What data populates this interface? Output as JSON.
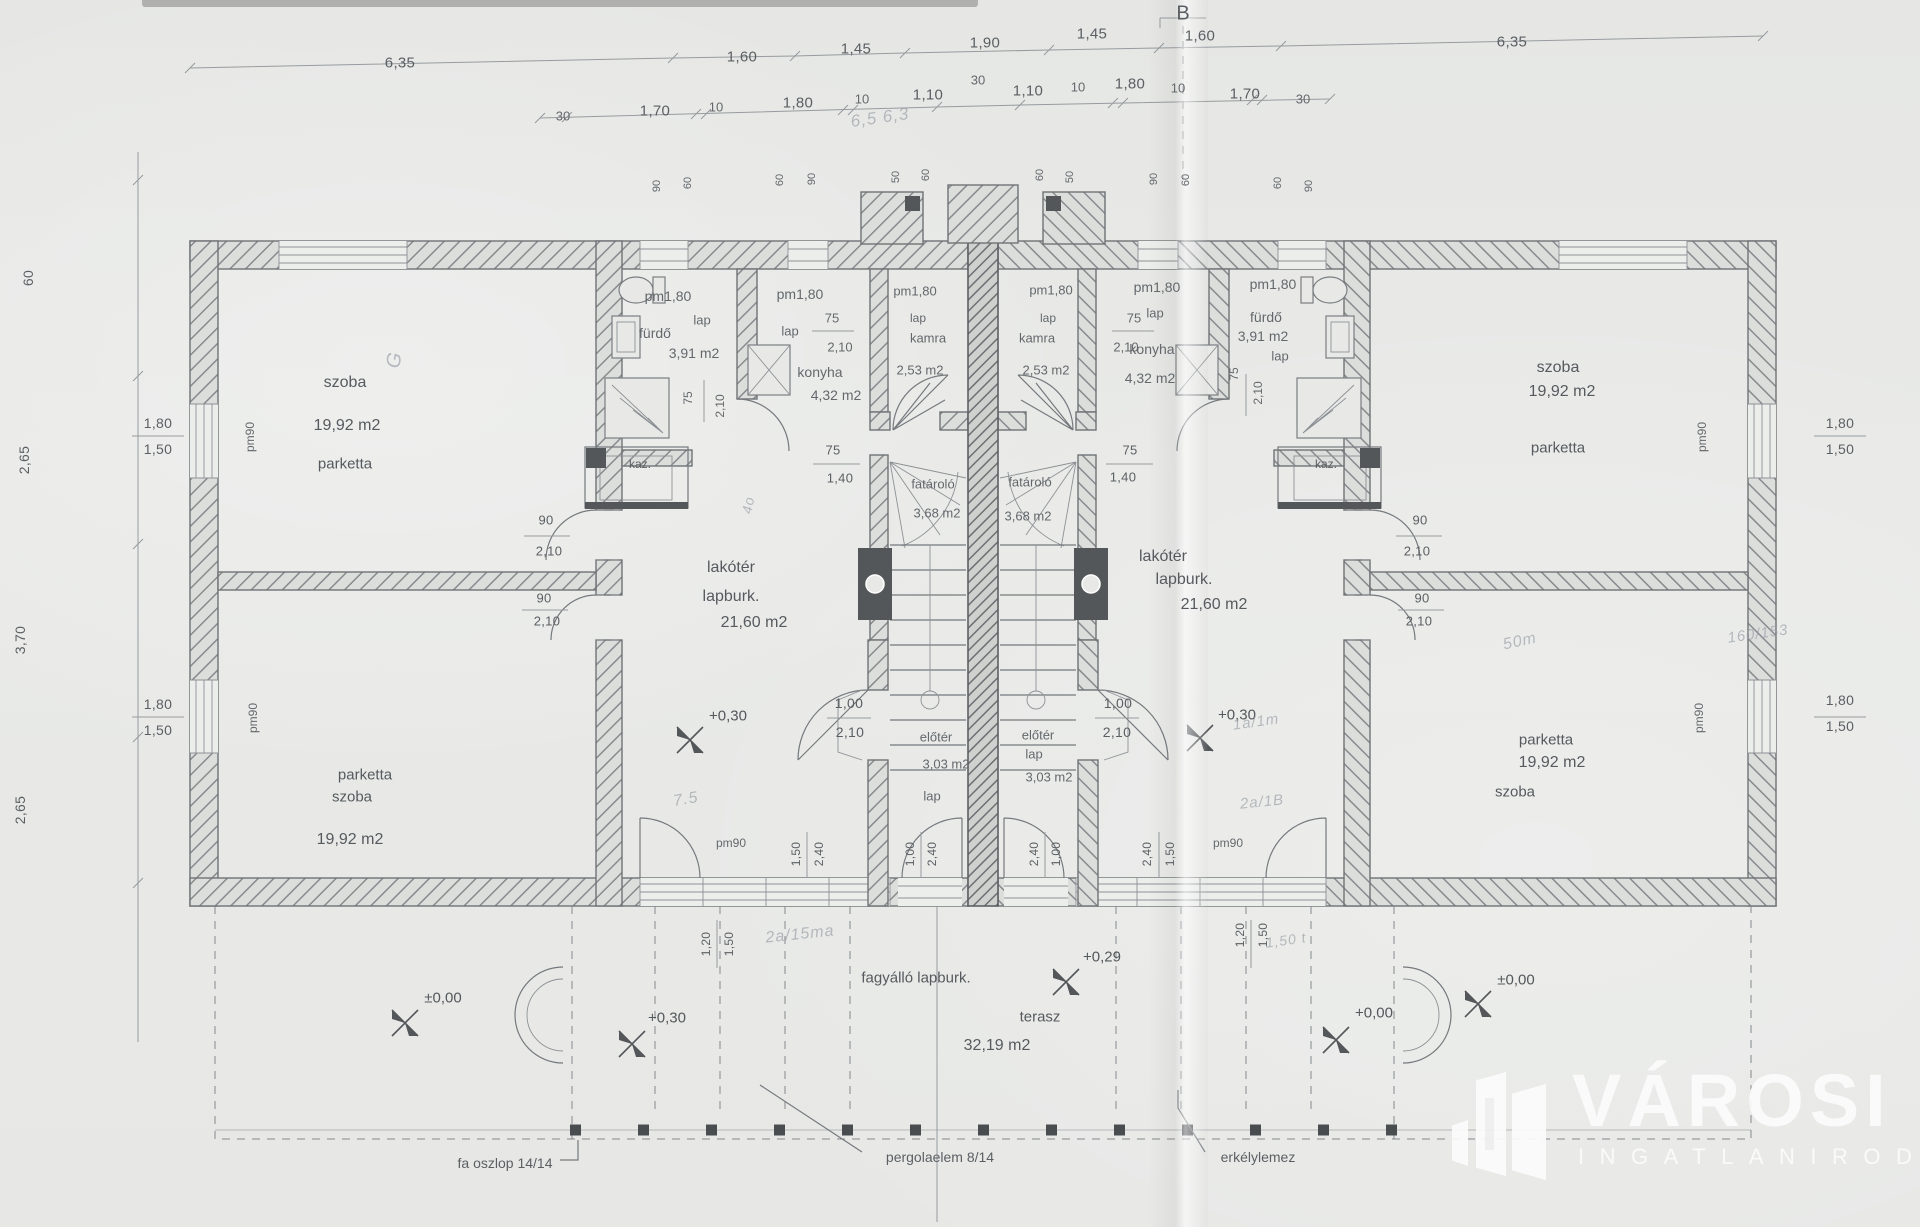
{
  "logo": {
    "name": "VÁROSI",
    "subtitle": "INGATLANIRODA"
  },
  "labels": [
    {
      "t": "6,35",
      "x": 400,
      "y": 63,
      "s": 15
    },
    {
      "t": "1,60",
      "x": 742,
      "y": 57,
      "s": 15
    },
    {
      "t": "1,45",
      "x": 856,
      "y": 49,
      "s": 15
    },
    {
      "t": "1,90",
      "x": 985,
      "y": 43,
      "s": 15
    },
    {
      "t": "1,45",
      "x": 1092,
      "y": 34,
      "s": 15
    },
    {
      "t": "1,60",
      "x": 1200,
      "y": 36,
      "s": 15
    },
    {
      "t": "6,35",
      "x": 1512,
      "y": 42,
      "s": 15
    },
    {
      "t": "30",
      "x": 563,
      "y": 116,
      "s": 13,
      "c": "sml"
    },
    {
      "t": "1,70",
      "x": 655,
      "y": 111,
      "s": 15
    },
    {
      "t": "10",
      "x": 716,
      "y": 107,
      "s": 13,
      "c": "sml"
    },
    {
      "t": "1,80",
      "x": 798,
      "y": 103,
      "s": 15
    },
    {
      "t": "10",
      "x": 862,
      "y": 99,
      "s": 13,
      "c": "sml"
    },
    {
      "t": "1,10",
      "x": 928,
      "y": 95,
      "s": 15
    },
    {
      "t": "30",
      "x": 978,
      "y": 80,
      "s": 13,
      "c": "sml"
    },
    {
      "t": "1,10",
      "x": 1028,
      "y": 91,
      "s": 15
    },
    {
      "t": "10",
      "x": 1078,
      "y": 87,
      "s": 13,
      "c": "sml"
    },
    {
      "t": "1,80",
      "x": 1130,
      "y": 84,
      "s": 15
    },
    {
      "t": "10",
      "x": 1178,
      "y": 88,
      "s": 13,
      "c": "sml"
    },
    {
      "t": "1,70",
      "x": 1245,
      "y": 94,
      "s": 15
    },
    {
      "t": "30",
      "x": 1303,
      "y": 99,
      "s": 13,
      "c": "sml"
    },
    {
      "t": "B",
      "x": 1183,
      "y": 14,
      "s": 20,
      "c": "ann"
    },
    {
      "t": "90",
      "x": 657,
      "y": 186,
      "s": 11,
      "r": -90,
      "c": "vert"
    },
    {
      "t": "60",
      "x": 688,
      "y": 183,
      "s": 11,
      "r": -90,
      "c": "vert"
    },
    {
      "t": "60",
      "x": 780,
      "y": 180,
      "s": 11,
      "r": -90,
      "c": "vert"
    },
    {
      "t": "90",
      "x": 812,
      "y": 179,
      "s": 11,
      "r": -90,
      "c": "vert"
    },
    {
      "t": "50",
      "x": 896,
      "y": 177,
      "s": 11,
      "r": -90,
      "c": "vert"
    },
    {
      "t": "60",
      "x": 926,
      "y": 175,
      "s": 11,
      "r": -90,
      "c": "vert"
    },
    {
      "t": "60",
      "x": 1040,
      "y": 175,
      "s": 11,
      "r": -90,
      "c": "vert"
    },
    {
      "t": "50",
      "x": 1070,
      "y": 177,
      "s": 11,
      "r": -90,
      "c": "vert"
    },
    {
      "t": "90",
      "x": 1154,
      "y": 179,
      "s": 11,
      "r": -90,
      "c": "vert"
    },
    {
      "t": "60",
      "x": 1186,
      "y": 180,
      "s": 11,
      "r": -90,
      "c": "vert"
    },
    {
      "t": "60",
      "x": 1278,
      "y": 183,
      "s": 11,
      "r": -90,
      "c": "vert"
    },
    {
      "t": "90",
      "x": 1309,
      "y": 186,
      "s": 11,
      "r": -90,
      "c": "vert"
    },
    {
      "t": "60",
      "x": 28,
      "y": 278,
      "s": 14,
      "r": -90
    },
    {
      "t": "2,65",
      "x": 24,
      "y": 460,
      "s": 14,
      "r": -90
    },
    {
      "t": "3,70",
      "x": 20,
      "y": 640,
      "s": 14,
      "r": -90
    },
    {
      "t": "2,65",
      "x": 20,
      "y": 810,
      "s": 14,
      "r": -90
    },
    {
      "t": "1,80",
      "x": 158,
      "y": 423,
      "s": 14
    },
    {
      "t": "1,50",
      "x": 158,
      "y": 449,
      "s": 14
    },
    {
      "t": "pm90",
      "x": 250,
      "y": 437,
      "s": 12,
      "r": -90,
      "c": "sml"
    },
    {
      "t": "1,80",
      "x": 158,
      "y": 704,
      "s": 14
    },
    {
      "t": "1,50",
      "x": 158,
      "y": 730,
      "s": 14
    },
    {
      "t": "pm90",
      "x": 253,
      "y": 718,
      "s": 12,
      "r": -90,
      "c": "sml"
    },
    {
      "t": "1,80",
      "x": 1840,
      "y": 423,
      "s": 14
    },
    {
      "t": "1,50",
      "x": 1840,
      "y": 449,
      "s": 14
    },
    {
      "t": "pm90",
      "x": 1702,
      "y": 437,
      "s": 12,
      "r": -90,
      "c": "sml"
    },
    {
      "t": "1,80",
      "x": 1840,
      "y": 700,
      "s": 14
    },
    {
      "t": "1,50",
      "x": 1840,
      "y": 726,
      "s": 14
    },
    {
      "t": "pm90",
      "x": 1699,
      "y": 718,
      "s": 12,
      "r": -90,
      "c": "sml"
    },
    {
      "t": "szoba",
      "x": 345,
      "y": 383,
      "s": 16,
      "c": "room"
    },
    {
      "t": "19,92 m2",
      "x": 347,
      "y": 426,
      "s": 16,
      "c": "room"
    },
    {
      "t": "parketta",
      "x": 345,
      "y": 464,
      "s": 15,
      "c": "room"
    },
    {
      "t": "parketta",
      "x": 365,
      "y": 775,
      "s": 15,
      "c": "room"
    },
    {
      "t": "szoba",
      "x": 352,
      "y": 797,
      "s": 15,
      "c": "room"
    },
    {
      "t": "19,92 m2",
      "x": 350,
      "y": 840,
      "s": 16,
      "c": "room"
    },
    {
      "t": "pm1,80",
      "x": 668,
      "y": 296,
      "s": 14,
      "c": "sml"
    },
    {
      "t": "lap",
      "x": 702,
      "y": 320,
      "s": 13,
      "c": "sml"
    },
    {
      "t": "fürdő",
      "x": 655,
      "y": 333,
      "s": 14,
      "c": "sml"
    },
    {
      "t": "3,91 m2",
      "x": 694,
      "y": 353,
      "s": 14,
      "c": "sml"
    },
    {
      "t": "75",
      "x": 688,
      "y": 398,
      "s": 12,
      "r": -90,
      "c": "sml"
    },
    {
      "t": "2,10",
      "x": 720,
      "y": 406,
      "s": 12,
      "r": -90,
      "c": "sml"
    },
    {
      "t": "pm1,80",
      "x": 800,
      "y": 294,
      "s": 14,
      "c": "sml"
    },
    {
      "t": "lap",
      "x": 790,
      "y": 331,
      "s": 13,
      "c": "sml"
    },
    {
      "t": "75",
      "x": 832,
      "y": 318,
      "s": 13,
      "c": "sml"
    },
    {
      "t": "2,10",
      "x": 840,
      "y": 347,
      "s": 13,
      "c": "sml"
    },
    {
      "t": "konyha",
      "x": 820,
      "y": 372,
      "s": 14,
      "c": "sml"
    },
    {
      "t": "4,32 m2",
      "x": 836,
      "y": 395,
      "s": 14,
      "c": "sml"
    },
    {
      "t": "pm1,80",
      "x": 915,
      "y": 291,
      "s": 13,
      "c": "sml"
    },
    {
      "t": "lap",
      "x": 918,
      "y": 318,
      "s": 12,
      "c": "sml"
    },
    {
      "t": "kamra",
      "x": 928,
      "y": 338,
      "s": 13,
      "c": "sml"
    },
    {
      "t": "2,53 m2",
      "x": 920,
      "y": 370,
      "s": 13,
      "c": "sml"
    },
    {
      "t": "kaz.",
      "x": 640,
      "y": 464,
      "s": 12,
      "c": "ann"
    },
    {
      "t": "90",
      "x": 546,
      "y": 520,
      "s": 13
    },
    {
      "t": "2,10",
      "x": 549,
      "y": 551,
      "s": 13
    },
    {
      "t": "90",
      "x": 544,
      "y": 598,
      "s": 13
    },
    {
      "t": "2,10",
      "x": 547,
      "y": 621,
      "s": 13
    },
    {
      "t": "lakótér",
      "x": 731,
      "y": 568,
      "s": 16,
      "c": "room"
    },
    {
      "t": "lapburk.",
      "x": 731,
      "y": 597,
      "s": 16,
      "c": "room"
    },
    {
      "t": "21,60 m2",
      "x": 754,
      "y": 623,
      "s": 16,
      "c": "room"
    },
    {
      "t": "75",
      "x": 833,
      "y": 450,
      "s": 13
    },
    {
      "t": "1,40",
      "x": 840,
      "y": 478,
      "s": 13
    },
    {
      "t": "fatároló",
      "x": 933,
      "y": 484,
      "s": 13,
      "c": "sml"
    },
    {
      "t": "3,68 m2",
      "x": 937,
      "y": 513,
      "s": 13,
      "c": "sml"
    },
    {
      "t": "+0,30",
      "x": 728,
      "y": 716,
      "s": 15,
      "c": "lvl"
    },
    {
      "t": "1,00",
      "x": 849,
      "y": 703,
      "s": 14
    },
    {
      "t": "2,10",
      "x": 850,
      "y": 732,
      "s": 14
    },
    {
      "t": "előtér",
      "x": 936,
      "y": 737,
      "s": 13,
      "c": "sml"
    },
    {
      "t": "3,03 m2",
      "x": 946,
      "y": 764,
      "s": 13,
      "c": "sml"
    },
    {
      "t": "lap",
      "x": 932,
      "y": 796,
      "s": 13,
      "c": "sml"
    },
    {
      "t": "pm90",
      "x": 731,
      "y": 843,
      "s": 12,
      "c": "sml"
    },
    {
      "t": "1,50",
      "x": 796,
      "y": 854,
      "s": 12,
      "r": -90
    },
    {
      "t": "2,40",
      "x": 819,
      "y": 854,
      "s": 12,
      "r": -90
    },
    {
      "t": "1,00",
      "x": 910,
      "y": 854,
      "s": 12,
      "r": -90
    },
    {
      "t": "2,40",
      "x": 932,
      "y": 854,
      "s": 12,
      "r": -90
    },
    {
      "t": "1,20",
      "x": 706,
      "y": 944,
      "s": 12,
      "r": -90
    },
    {
      "t": "1,50",
      "x": 729,
      "y": 944,
      "s": 12,
      "r": -90
    },
    {
      "t": "pm1,80",
      "x": 1051,
      "y": 290,
      "s": 13,
      "c": "sml"
    },
    {
      "t": "lap",
      "x": 1048,
      "y": 318,
      "s": 12,
      "c": "sml"
    },
    {
      "t": "kamra",
      "x": 1037,
      "y": 338,
      "s": 13,
      "c": "sml"
    },
    {
      "t": "2,53 m2",
      "x": 1046,
      "y": 370,
      "s": 13,
      "c": "sml"
    },
    {
      "t": "pm1,80",
      "x": 1157,
      "y": 287,
      "s": 14,
      "c": "sml"
    },
    {
      "t": "lap",
      "x": 1155,
      "y": 313,
      "s": 13,
      "c": "sml"
    },
    {
      "t": "75",
      "x": 1134,
      "y": 318,
      "s": 13,
      "c": "sml"
    },
    {
      "t": "2,10",
      "x": 1126,
      "y": 347,
      "s": 13,
      "c": "sml"
    },
    {
      "t": "konyha",
      "x": 1152,
      "y": 349,
      "s": 14,
      "c": "sml"
    },
    {
      "t": "4,32 m2",
      "x": 1150,
      "y": 378,
      "s": 14,
      "c": "sml"
    },
    {
      "t": "pm1,80",
      "x": 1273,
      "y": 284,
      "s": 14,
      "c": "sml"
    },
    {
      "t": "fürdő",
      "x": 1266,
      "y": 317,
      "s": 14,
      "c": "sml"
    },
    {
      "t": "3,91 m2",
      "x": 1263,
      "y": 336,
      "s": 14,
      "c": "sml"
    },
    {
      "t": "lap",
      "x": 1280,
      "y": 356,
      "s": 13,
      "c": "sml"
    },
    {
      "t": "75",
      "x": 1234,
      "y": 374,
      "s": 12,
      "r": -90,
      "c": "sml"
    },
    {
      "t": "2,10",
      "x": 1258,
      "y": 393,
      "s": 12,
      "r": -90,
      "c": "sml"
    },
    {
      "t": "kaz.",
      "x": 1326,
      "y": 464,
      "s": 12,
      "c": "ann"
    },
    {
      "t": "szoba",
      "x": 1558,
      "y": 368,
      "s": 16,
      "c": "room"
    },
    {
      "t": "19,92 m2",
      "x": 1562,
      "y": 392,
      "s": 16,
      "c": "room"
    },
    {
      "t": "parketta",
      "x": 1558,
      "y": 448,
      "s": 15,
      "c": "room"
    },
    {
      "t": "lakótér",
      "x": 1163,
      "y": 557,
      "s": 16,
      "c": "room"
    },
    {
      "t": "lapburk.",
      "x": 1184,
      "y": 580,
      "s": 16,
      "c": "room"
    },
    {
      "t": "21,60 m2",
      "x": 1214,
      "y": 605,
      "s": 16,
      "c": "room"
    },
    {
      "t": "75",
      "x": 1130,
      "y": 450,
      "s": 13
    },
    {
      "t": "1,40",
      "x": 1123,
      "y": 477,
      "s": 13
    },
    {
      "t": "fatároló",
      "x": 1030,
      "y": 482,
      "s": 13,
      "c": "sml"
    },
    {
      "t": "3,68 m2",
      "x": 1028,
      "y": 516,
      "s": 13,
      "c": "sml"
    },
    {
      "t": "+0,30",
      "x": 1237,
      "y": 715,
      "s": 15,
      "c": "lvl"
    },
    {
      "t": "1,00",
      "x": 1118,
      "y": 703,
      "s": 14
    },
    {
      "t": "2,10",
      "x": 1117,
      "y": 732,
      "s": 14
    },
    {
      "t": "előtér",
      "x": 1038,
      "y": 735,
      "s": 13,
      "c": "sml"
    },
    {
      "t": "lap",
      "x": 1034,
      "y": 754,
      "s": 13,
      "c": "sml"
    },
    {
      "t": "3,03 m2",
      "x": 1049,
      "y": 777,
      "s": 13,
      "c": "sml"
    },
    {
      "t": "pm90",
      "x": 1228,
      "y": 843,
      "s": 12,
      "c": "sml"
    },
    {
      "t": "2,40",
      "x": 1034,
      "y": 854,
      "s": 12,
      "r": -90
    },
    {
      "t": "1,00",
      "x": 1056,
      "y": 854,
      "s": 12,
      "r": -90
    },
    {
      "t": "2,40",
      "x": 1147,
      "y": 854,
      "s": 12,
      "r": -90
    },
    {
      "t": "1,50",
      "x": 1170,
      "y": 854,
      "s": 12,
      "r": -90
    },
    {
      "t": "1,20",
      "x": 1240,
      "y": 935,
      "s": 12,
      "r": -90
    },
    {
      "t": "1,50",
      "x": 1263,
      "y": 935,
      "s": 12,
      "r": -90
    },
    {
      "t": "90",
      "x": 1420,
      "y": 520,
      "s": 13
    },
    {
      "t": "2,10",
      "x": 1417,
      "y": 551,
      "s": 13
    },
    {
      "t": "90",
      "x": 1422,
      "y": 598,
      "s": 13
    },
    {
      "t": "2,10",
      "x": 1419,
      "y": 621,
      "s": 13
    },
    {
      "t": "parketta",
      "x": 1546,
      "y": 740,
      "s": 15,
      "c": "room"
    },
    {
      "t": "19,92 m2",
      "x": 1552,
      "y": 763,
      "s": 16,
      "c": "room"
    },
    {
      "t": "szoba",
      "x": 1515,
      "y": 792,
      "s": 15,
      "c": "room"
    },
    {
      "t": "fagyálló lapburk.",
      "x": 916,
      "y": 978,
      "s": 15,
      "c": "room"
    },
    {
      "t": "terasz",
      "x": 1040,
      "y": 1017,
      "s": 15,
      "c": "room"
    },
    {
      "t": "32,19 m2",
      "x": 997,
      "y": 1046,
      "s": 16,
      "c": "room"
    },
    {
      "t": "+0,29",
      "x": 1102,
      "y": 957,
      "s": 15,
      "c": "lvl"
    },
    {
      "t": "+0,30",
      "x": 667,
      "y": 1018,
      "s": 15,
      "c": "lvl"
    },
    {
      "t": "+0,00",
      "x": 1374,
      "y": 1013,
      "s": 15,
      "c": "lvl"
    },
    {
      "t": "±0,00",
      "x": 443,
      "y": 998,
      "s": 15,
      "c": "lvl"
    },
    {
      "t": "±0,00",
      "x": 1516,
      "y": 980,
      "s": 15,
      "c": "lvl"
    },
    {
      "t": "fa oszlop 14/14",
      "x": 505,
      "y": 1163,
      "s": 14,
      "c": "ann"
    },
    {
      "t": "pergolaelem 8/14",
      "x": 940,
      "y": 1157,
      "s": 14,
      "c": "ann"
    },
    {
      "t": "erkélylemez",
      "x": 1258,
      "y": 1157,
      "s": 14,
      "c": "ann"
    },
    {
      "t": "6,5  6,3",
      "x": 880,
      "y": 118,
      "s": 17,
      "r": -8,
      "c": "hand"
    },
    {
      "t": "7.5",
      "x": 686,
      "y": 800,
      "s": 16,
      "r": -10,
      "c": "hand"
    },
    {
      "t": "2a/15ma",
      "x": 800,
      "y": 935,
      "s": 16,
      "r": -6,
      "c": "hand"
    },
    {
      "t": "1a/1m",
      "x": 1256,
      "y": 722,
      "s": 15,
      "r": -8,
      "c": "hand"
    },
    {
      "t": "2a/1B",
      "x": 1262,
      "y": 802,
      "s": 15,
      "r": -6,
      "c": "hand"
    },
    {
      "t": "1,50 t",
      "x": 1286,
      "y": 940,
      "s": 14,
      "r": -8,
      "c": "hand"
    },
    {
      "t": "50m",
      "x": 1520,
      "y": 642,
      "s": 16,
      "r": -12,
      "c": "hand"
    },
    {
      "t": "160/153",
      "x": 1758,
      "y": 634,
      "s": 15,
      "r": -8,
      "c": "hand"
    },
    {
      "t": "4o",
      "x": 748,
      "y": 505,
      "s": 14,
      "r": -80,
      "c": "hand"
    },
    {
      "t": "G",
      "x": 395,
      "y": 360,
      "s": 20,
      "r": -80,
      "c": "hand"
    }
  ]
}
